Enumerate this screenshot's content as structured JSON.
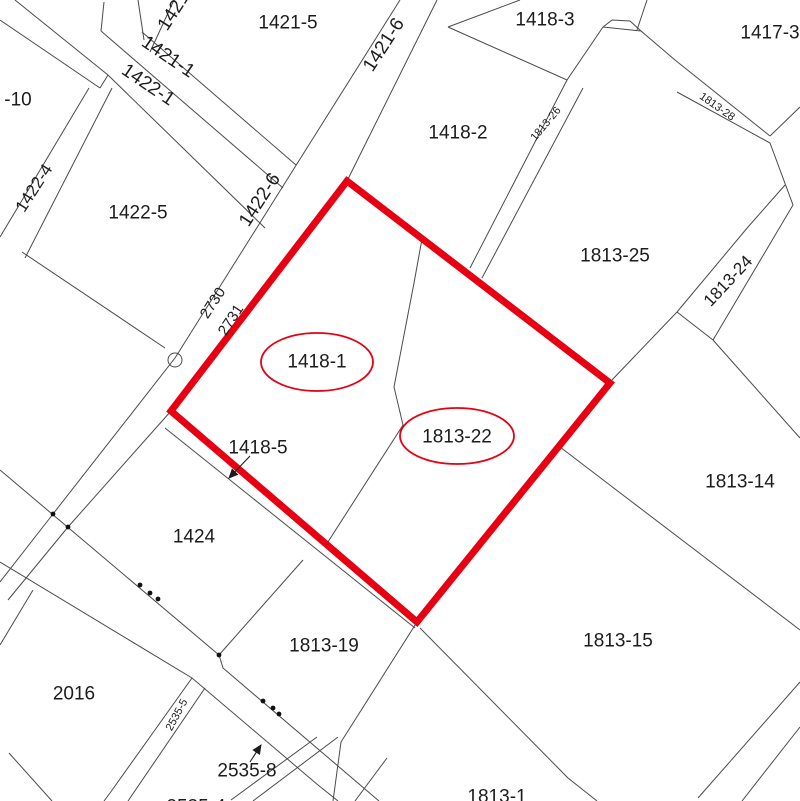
{
  "map": {
    "title": "cadastral-parcel-map",
    "background": "#ffffff",
    "line_color": "#4a4a4a",
    "text_color": "#1c1c1c",
    "red": "#e60012",
    "highlight_polygon": {
      "points": [
        [
          347,
          181
        ],
        [
          610,
          383
        ],
        [
          417,
          622
        ],
        [
          171,
          411
        ]
      ],
      "stroke_width": 7
    },
    "ellipses": [
      {
        "label": "1418-1",
        "cx": 317,
        "cy": 362,
        "rx": 56,
        "ry": 29
      },
      {
        "label": "1813-22",
        "cx": 457,
        "cy": 436,
        "rx": 57,
        "ry": 28
      }
    ],
    "labels": [
      {
        "text": "1421-5",
        "x": 288,
        "y": 23,
        "rot": 0,
        "size": 19
      },
      {
        "text": "1418-3",
        "x": 545,
        "y": 20,
        "rot": 0,
        "size": 19
      },
      {
        "text": "1417-3",
        "x": 770,
        "y": 33,
        "rot": 0,
        "size": 19
      },
      {
        "text": "1418-2",
        "x": 458,
        "y": 133,
        "rot": 0,
        "size": 19
      },
      {
        "text": "1813-25",
        "x": 615,
        "y": 256,
        "rot": 0,
        "size": 19
      },
      {
        "text": "1418-1",
        "x": 317,
        "y": 362,
        "rot": 0,
        "size": 19
      },
      {
        "text": "1813-22",
        "x": 457,
        "y": 437,
        "rot": 0,
        "size": 19
      },
      {
        "text": "1422-5",
        "x": 138,
        "y": 213,
        "rot": 0,
        "size": 19
      },
      {
        "text": "-10",
        "x": 18,
        "y": 100,
        "rot": 0,
        "size": 19
      },
      {
        "text": "1418-5",
        "x": 258,
        "y": 448,
        "rot": 0,
        "size": 19
      },
      {
        "text": "1424",
        "x": 194,
        "y": 537,
        "rot": 0,
        "size": 19
      },
      {
        "text": "2016",
        "x": 74,
        "y": 694,
        "rot": 0,
        "size": 19
      },
      {
        "text": "1813-19",
        "x": 324,
        "y": 646,
        "rot": 0,
        "size": 19
      },
      {
        "text": "1813-15",
        "x": 618,
        "y": 641,
        "rot": 0,
        "size": 19
      },
      {
        "text": "1813-14",
        "x": 740,
        "y": 482,
        "rot": 0,
        "size": 19
      },
      {
        "text": "1813-1",
        "x": 497,
        "y": 797,
        "rot": 0,
        "size": 19
      },
      {
        "text": "2535-8",
        "x": 247,
        "y": 771,
        "rot": 0,
        "size": 19
      },
      {
        "text": "2535-4",
        "x": 196,
        "y": 807,
        "rot": 0,
        "size": 19
      },
      {
        "text": "1421-6",
        "x": 384,
        "y": 45,
        "rot": -57,
        "size": 19
      },
      {
        "text": "1421",
        "x": 174,
        "y": 11,
        "rot": -57,
        "size": 19
      },
      {
        "text": "1421-1",
        "x": 168,
        "y": 57,
        "rot": 34,
        "size": 19
      },
      {
        "text": "1422-1",
        "x": 148,
        "y": 85,
        "rot": 34,
        "size": 19
      },
      {
        "text": "1422-6",
        "x": 260,
        "y": 200,
        "rot": -57,
        "size": 19
      },
      {
        "text": "1422-4",
        "x": 34,
        "y": 188,
        "rot": -57,
        "size": 17
      },
      {
        "text": "2730",
        "x": 213,
        "y": 303,
        "rot": -57,
        "size": 15
      },
      {
        "text": "2731",
        "x": 231,
        "y": 320,
        "rot": -57,
        "size": 15
      },
      {
        "text": "1813-26",
        "x": 546,
        "y": 124,
        "rot": -50,
        "size": 11
      },
      {
        "text": "1813-28",
        "x": 717,
        "y": 107,
        "rot": 35,
        "size": 11
      },
      {
        "text": "1813-24",
        "x": 728,
        "y": 281,
        "rot": -47,
        "size": 17
      },
      {
        "text": "2535-5",
        "x": 177,
        "y": 715,
        "rot": -62,
        "size": 11
      }
    ],
    "lines": [
      {
        "points": [
          [
            400,
            0
          ],
          [
            295,
            167
          ],
          [
            175,
            358
          ],
          [
            53,
            514
          ],
          [
            0,
            582
          ]
        ]
      },
      {
        "points": [
          [
            437,
            0
          ],
          [
            347,
            181
          ]
        ]
      },
      {
        "points": [
          [
            347,
            181
          ],
          [
            171,
            411
          ]
        ]
      },
      {
        "points": [
          [
            171,
            411
          ],
          [
            68,
            527
          ],
          [
            8,
            600
          ]
        ]
      },
      {
        "points": [
          [
            0,
            470
          ],
          [
            219,
            655
          ],
          [
            223,
            668
          ],
          [
            379,
            801
          ]
        ]
      },
      {
        "points": [
          [
            0,
            562
          ],
          [
            192,
            678
          ],
          [
            318,
            785
          ],
          [
            338,
            801
          ]
        ]
      },
      {
        "points": [
          [
            33,
            590
          ],
          [
            0,
            645
          ]
        ]
      },
      {
        "points": [
          [
            9,
            753
          ],
          [
            52,
            801
          ]
        ]
      },
      {
        "points": [
          [
            192,
            678
          ],
          [
            110,
            793
          ],
          [
            104,
            801
          ]
        ]
      },
      {
        "points": [
          [
            205,
            688
          ],
          [
            128,
            801
          ]
        ]
      },
      {
        "points": [
          [
            317,
            737
          ],
          [
            231,
            800
          ]
        ]
      },
      {
        "points": [
          [
            338,
            737
          ],
          [
            253,
            801
          ]
        ]
      },
      {
        "points": [
          [
            387,
            758
          ],
          [
            355,
            801
          ]
        ]
      },
      {
        "points": [
          [
            303,
            560
          ],
          [
            219,
            655
          ]
        ]
      },
      {
        "points": [
          [
            165,
            428
          ],
          [
            415,
            628
          ]
        ]
      },
      {
        "points": [
          [
            417,
            622
          ],
          [
            341,
            742
          ],
          [
            333,
            801
          ]
        ]
      },
      {
        "points": [
          [
            420,
            628
          ],
          [
            568,
            778
          ],
          [
            597,
            801
          ]
        ]
      },
      {
        "points": [
          [
            560,
            447
          ],
          [
            800,
            630
          ]
        ]
      },
      {
        "points": [
          [
            698,
            798
          ],
          [
            800,
            682
          ]
        ]
      },
      {
        "points": [
          [
            742,
            801
          ],
          [
            800,
            727
          ]
        ]
      },
      {
        "points": [
          [
            422,
            239
          ],
          [
            414,
            283
          ],
          [
            394,
            387
          ],
          [
            403,
            425
          ],
          [
            326,
            545
          ]
        ]
      },
      {
        "points": [
          [
            347,
            181
          ],
          [
            610,
            383
          ]
        ]
      },
      {
        "points": [
          [
            610,
            383
          ],
          [
            417,
            622
          ]
        ]
      },
      {
        "points": [
          [
            171,
            411
          ],
          [
            417,
            622
          ]
        ]
      },
      {
        "points": [
          [
            15,
            0
          ],
          [
            108,
            75
          ]
        ]
      },
      {
        "points": [
          [
            0,
            20
          ],
          [
            100,
            88
          ]
        ]
      },
      {
        "points": [
          [
            104,
            2
          ],
          [
            101,
            31
          ]
        ]
      },
      {
        "points": [
          [
            138,
            0
          ],
          [
            144,
            40
          ]
        ]
      },
      {
        "points": [
          [
            174,
            0
          ],
          [
            150,
            52
          ]
        ]
      },
      {
        "points": [
          [
            142,
            32
          ],
          [
            296,
            165
          ]
        ]
      },
      {
        "points": [
          [
            101,
            31
          ],
          [
            283,
            188
          ]
        ]
      },
      {
        "points": [
          [
            108,
            75
          ],
          [
            265,
            228
          ]
        ]
      },
      {
        "points": [
          [
            100,
            88
          ],
          [
            108,
            75
          ]
        ]
      },
      {
        "points": [
          [
            89,
            88
          ],
          [
            18,
            207
          ],
          [
            0,
            237
          ]
        ]
      },
      {
        "points": [
          [
            112,
            88
          ],
          [
            25,
            258
          ]
        ]
      },
      {
        "points": [
          [
            22,
            252
          ],
          [
            165,
            348
          ]
        ]
      },
      {
        "points": [
          [
            448,
            27
          ],
          [
            520,
            0
          ]
        ]
      },
      {
        "points": [
          [
            448,
            27
          ],
          [
            567,
            80
          ],
          [
            603,
            27
          ]
        ]
      },
      {
        "points": [
          [
            603,
            27
          ],
          [
            612,
            20
          ],
          [
            630,
            21
          ],
          [
            641,
            31
          ],
          [
            603,
            27
          ]
        ]
      },
      {
        "points": [
          [
            647,
            0
          ],
          [
            637,
            30
          ]
        ]
      },
      {
        "points": [
          [
            641,
            31
          ],
          [
            675,
            60
          ],
          [
            770,
            136
          ]
        ]
      },
      {
        "points": [
          [
            677,
            92
          ],
          [
            770,
            143
          ],
          [
            793,
            205
          ],
          [
            713,
            340
          ]
        ]
      },
      {
        "points": [
          [
            770,
            136
          ],
          [
            800,
            107
          ]
        ]
      },
      {
        "points": [
          [
            785,
            185
          ],
          [
            748,
            227
          ],
          [
            677,
            312
          ]
        ]
      },
      {
        "points": [
          [
            677,
            312
          ],
          [
            713,
            340
          ]
        ]
      },
      {
        "points": [
          [
            612,
            380
          ],
          [
            677,
            312
          ]
        ]
      },
      {
        "points": [
          [
            713,
            340
          ],
          [
            800,
            438
          ]
        ]
      },
      {
        "points": [
          [
            567,
            80
          ],
          [
            470,
            268
          ]
        ]
      },
      {
        "points": [
          [
            583,
            88
          ],
          [
            482,
            278
          ]
        ]
      }
    ],
    "dots": [
      [
        53,
        514
      ],
      [
        68,
        527
      ],
      [
        140,
        585
      ],
      [
        150,
        593
      ],
      [
        158,
        599
      ],
      [
        219,
        655
      ],
      [
        263,
        701
      ],
      [
        273,
        708
      ],
      [
        279,
        714
      ]
    ],
    "circle_marker": {
      "cx": 175,
      "cy": 360,
      "r": 7
    },
    "arrows": [
      {
        "name": "arrow-1418-5",
        "from": [
          250,
          456
        ],
        "to": [
          229,
          478
        ]
      },
      {
        "name": "arrow-2535-8",
        "from": [
          250,
          762
        ],
        "to": [
          261,
          745
        ]
      }
    ]
  }
}
